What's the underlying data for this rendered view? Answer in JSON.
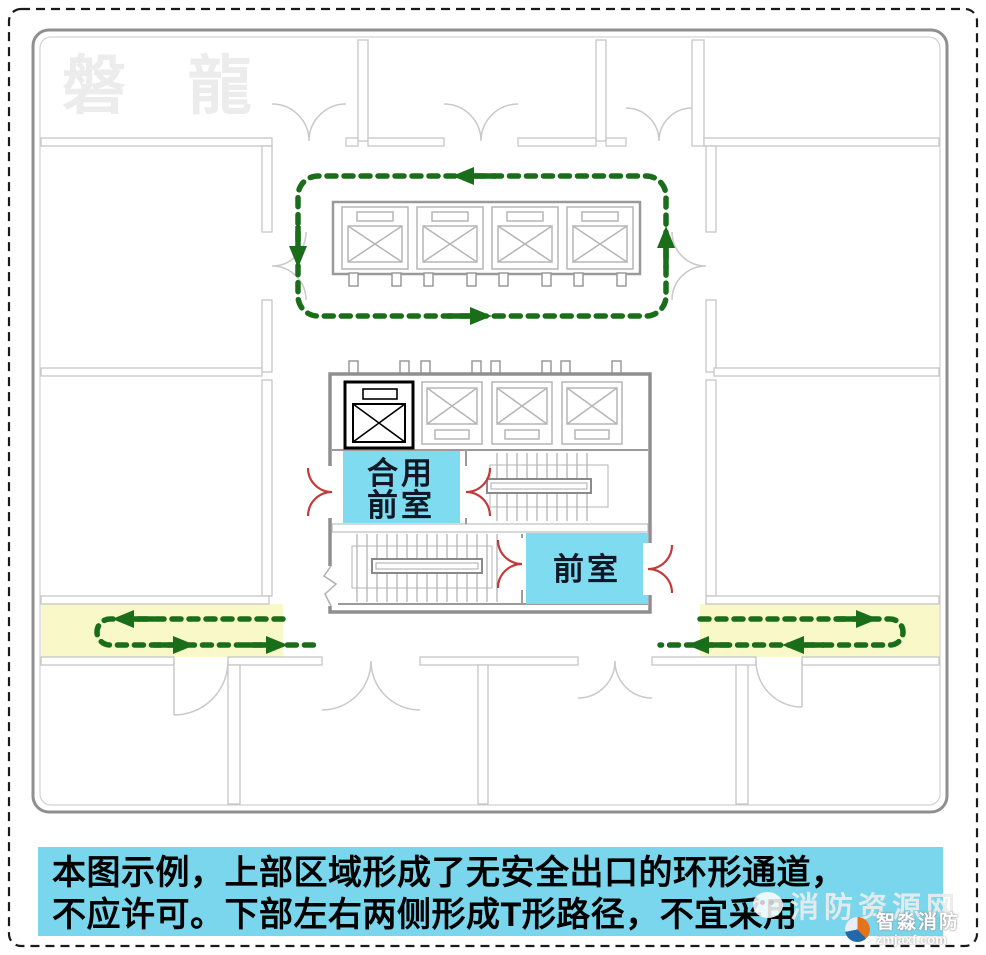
{
  "colors": {
    "route_green": "#1a6e1a",
    "highlight_yellow": "#f8f8c9",
    "room_blue": "#7fdbf0",
    "door_red": "#c23b3b",
    "caption_bg": "#79d6ec"
  },
  "plan": {
    "labels": {
      "shared_lobby_line1": "合用",
      "shared_lobby_line2": "前室",
      "lobby": "前室"
    }
  },
  "caption": {
    "line1": "本图示例，上部区域形成了无安全出口的环形通道，",
    "line2": "不应许可。下部左右两侧形成T形路径，不宜采用"
  },
  "watermarks": {
    "corner_brand": "磐 龍",
    "site_name": "消防资源网",
    "brand_name": "智淼消防",
    "brand_url": "zmjaxf.com"
  }
}
